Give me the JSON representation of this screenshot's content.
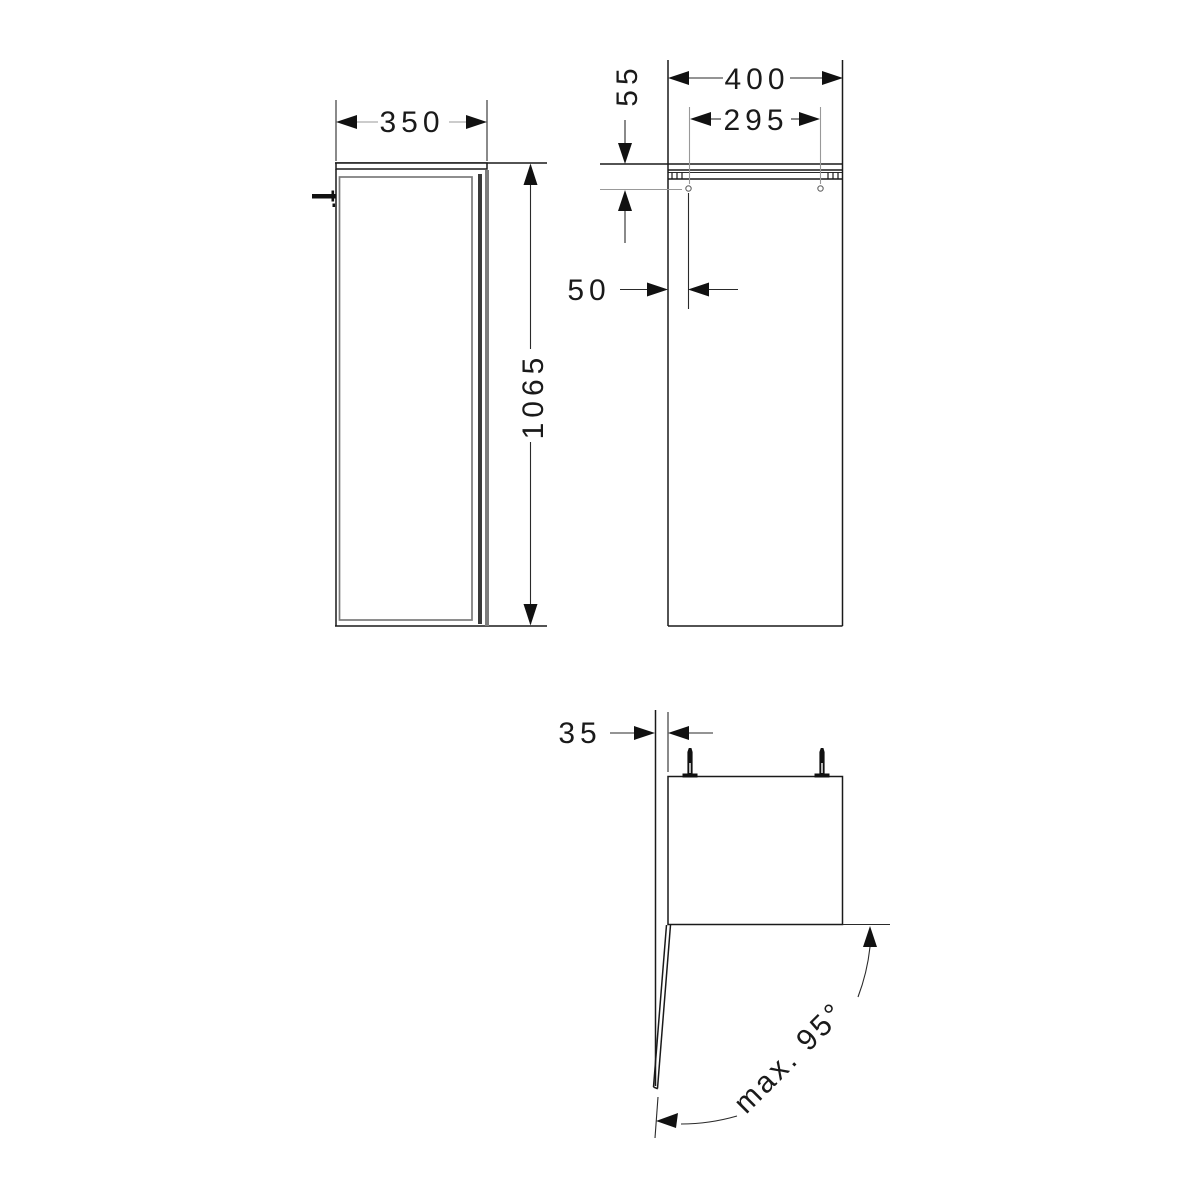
{
  "drawing": {
    "type": "technical-dimension-drawing",
    "dims": {
      "side_width": "350",
      "side_height": "1065",
      "front_width": "400",
      "hole_spacing": "295",
      "hole_top_offset": "55",
      "hole_side_offset": "50",
      "wall_offset": "35",
      "opening_angle": "max. 95°"
    },
    "colors": {
      "line": "#1a1a1a",
      "door_panel": "#7a7a7a",
      "background": "#ffffff"
    }
  }
}
